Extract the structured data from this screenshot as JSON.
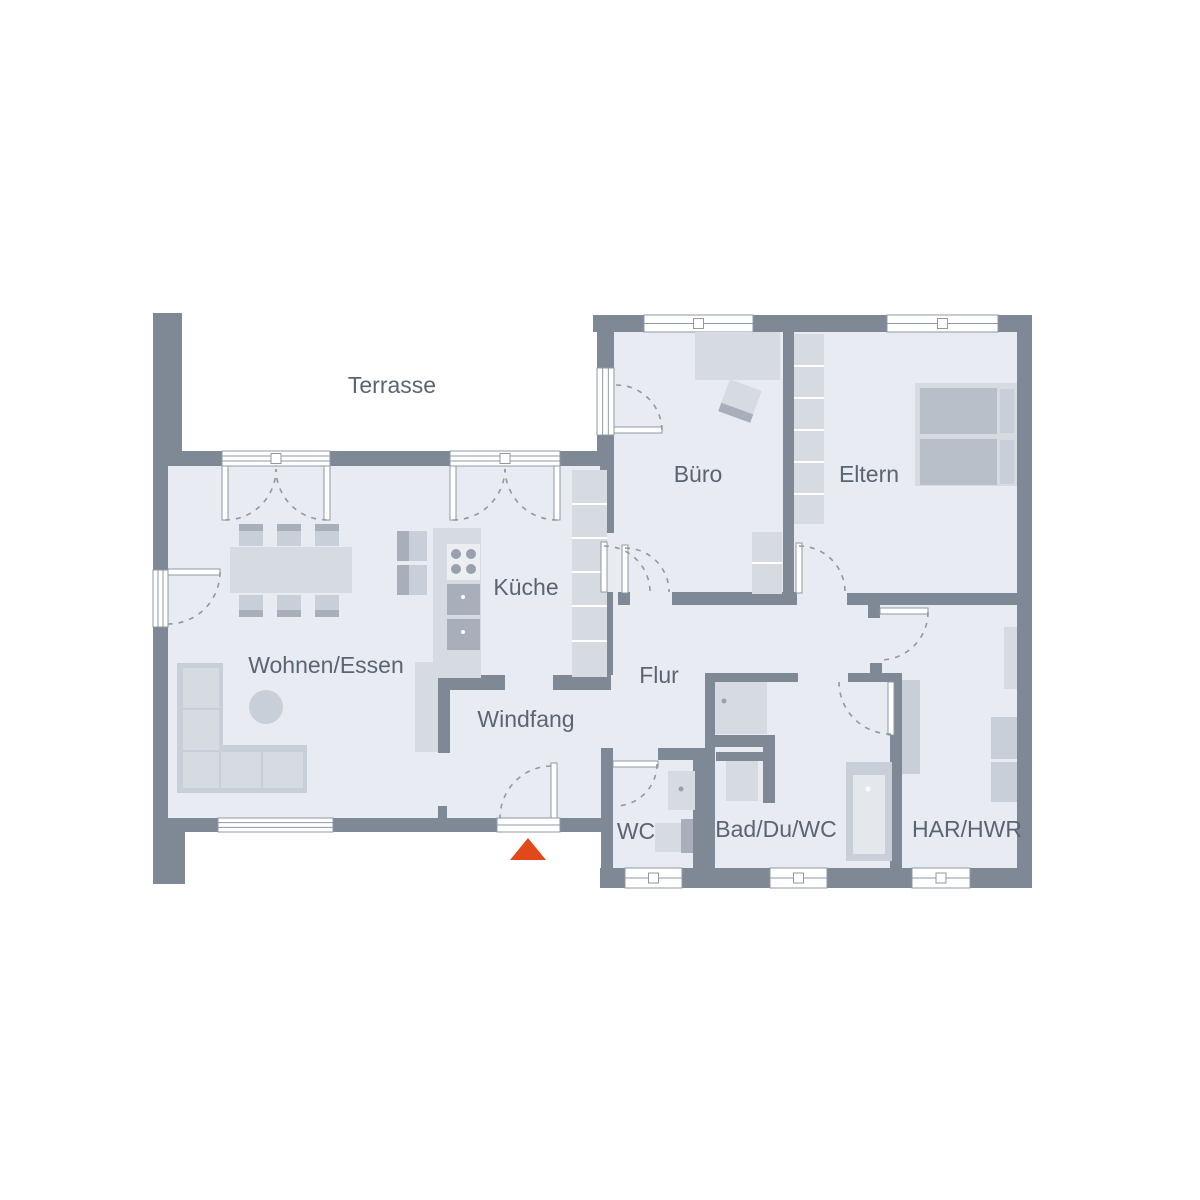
{
  "meta": {
    "title": "Grundriss Erdgeschoss"
  },
  "colors": {
    "background": "#ffffff",
    "wall": "#7f8995",
    "floor": "#e8ebf1",
    "furn1": "#d6dae1",
    "furn2": "#c9cfd8",
    "furn3": "#a8afbb",
    "matt": "#b9bfc9",
    "lite": "#e4e7ec",
    "panel": "#eceef2",
    "dark": "#98a1ad",
    "white": "#ffffff",
    "frame": "#8f98a4",
    "label": "#5b6472",
    "accent": "#e2491a"
  },
  "rooms": [
    {
      "id": "terrasse",
      "label": "Terrasse",
      "x": 392,
      "y": 387
    },
    {
      "id": "buero",
      "label": "Büro",
      "x": 698,
      "y": 476
    },
    {
      "id": "eltern",
      "label": "Eltern",
      "x": 869,
      "y": 476
    },
    {
      "id": "kueche",
      "label": "Küche",
      "x": 526,
      "y": 589
    },
    {
      "id": "wohnen-essen",
      "label": "Wohnen/Essen",
      "x": 326,
      "y": 667
    },
    {
      "id": "flur",
      "label": "Flur",
      "x": 659,
      "y": 677
    },
    {
      "id": "windfang",
      "label": "Windfang",
      "x": 526,
      "y": 721
    },
    {
      "id": "wc",
      "label": "WC",
      "x": 636,
      "y": 833
    },
    {
      "id": "bad-du-wc",
      "label": "Bad/Du/WC",
      "x": 776,
      "y": 831
    },
    {
      "id": "har-hwr",
      "label": "HAR/HWR",
      "x": 967,
      "y": 831
    }
  ],
  "plan": {
    "terrace_area": [
      182,
      313,
      415,
      138
    ],
    "floors": [
      [
        168,
        466,
        446,
        352
      ],
      [
        612,
        332,
        405,
        536
      ]
    ],
    "walls": [
      [
        153,
        313,
        29,
        149
      ],
      [
        153,
        451,
        15,
        381
      ],
      [
        153,
        832,
        32,
        52
      ],
      [
        168,
        451,
        54,
        15
      ],
      [
        330,
        451,
        120,
        15
      ],
      [
        560,
        451,
        54,
        15
      ],
      [
        168,
        818,
        50,
        14
      ],
      [
        333,
        818,
        164,
        14
      ],
      [
        560,
        818,
        53,
        14
      ],
      [
        438,
        806,
        9,
        12
      ],
      [
        597,
        315,
        17,
        53
      ],
      [
        597,
        435,
        17,
        16
      ],
      [
        593,
        315,
        51,
        17
      ],
      [
        753,
        315,
        134,
        17
      ],
      [
        998,
        315,
        34,
        17
      ],
      [
        1017,
        315,
        15,
        573
      ],
      [
        600,
        868,
        25,
        20
      ],
      [
        682,
        868,
        88,
        20
      ],
      [
        827,
        868,
        85,
        20
      ],
      [
        970,
        868,
        62,
        20
      ],
      [
        601,
        748,
        12,
        120
      ],
      [
        783,
        332,
        11,
        260
      ],
      [
        672,
        592,
        125,
        13
      ],
      [
        847,
        593,
        170,
        12
      ],
      [
        868,
        605,
        12,
        13
      ],
      [
        890,
        673,
        12,
        195
      ],
      [
        705,
        673,
        10,
        75
      ],
      [
        707,
        673,
        91,
        9
      ],
      [
        848,
        673,
        45,
        9
      ],
      [
        870,
        663,
        12,
        10
      ],
      [
        658,
        748,
        47,
        12
      ],
      [
        693,
        748,
        22,
        120
      ],
      [
        438,
        667,
        12,
        86
      ],
      [
        443,
        675,
        62,
        15
      ],
      [
        553,
        675,
        58,
        15
      ],
      [
        600,
        466,
        14,
        67
      ],
      [
        600,
        592,
        13,
        83
      ],
      [
        618,
        592,
        12,
        13
      ],
      [
        715,
        735,
        60,
        12
      ],
      [
        763,
        747,
        12,
        56
      ],
      [
        716,
        752,
        52,
        9
      ]
    ],
    "windows": [
      {
        "n": "french-door",
        "x": 222,
        "y": 451,
        "w": 108,
        "h": 15,
        "o": "h",
        "lines": 2,
        "sq": true
      },
      {
        "n": "french-door",
        "x": 450,
        "y": 451,
        "w": 110,
        "h": 15,
        "o": "h",
        "lines": 2,
        "sq": true
      },
      {
        "n": "window",
        "x": 644,
        "y": 315,
        "w": 109,
        "h": 17,
        "o": "h",
        "lines": 1,
        "sq": true
      },
      {
        "n": "window",
        "x": 887,
        "y": 315,
        "w": 111,
        "h": 17,
        "o": "h",
        "lines": 1,
        "sq": true
      },
      {
        "n": "window",
        "x": 218,
        "y": 818,
        "w": 115,
        "h": 14,
        "o": "h",
        "lines": 2,
        "sq": false
      },
      {
        "n": "entrance-sill",
        "x": 497,
        "y": 818,
        "w": 63,
        "h": 14,
        "o": "h",
        "lines": 1,
        "sq": false
      },
      {
        "n": "window",
        "x": 625,
        "y": 868,
        "w": 57,
        "h": 20,
        "o": "h",
        "lines": 1,
        "sq": true
      },
      {
        "n": "window",
        "x": 770,
        "y": 868,
        "w": 57,
        "h": 20,
        "o": "h",
        "lines": 1,
        "sq": true
      },
      {
        "n": "window",
        "x": 912,
        "y": 868,
        "w": 58,
        "h": 20,
        "o": "h",
        "lines": 1,
        "sq": true
      },
      {
        "n": "window-door",
        "x": 153,
        "y": 570,
        "w": 15,
        "h": 57,
        "o": "v",
        "lines": 2,
        "sq": false
      },
      {
        "n": "terrace-door",
        "x": 597,
        "y": 368,
        "w": 17,
        "h": 67,
        "o": "v",
        "lines": 2,
        "sq": false
      }
    ],
    "leaves": [
      [
        551,
        763,
        6,
        55
      ],
      [
        168,
        569,
        52,
        6
      ],
      [
        614,
        427,
        48,
        6
      ],
      [
        601,
        542,
        6,
        50
      ],
      [
        622,
        545,
        6,
        48
      ],
      [
        796,
        543,
        6,
        50
      ],
      [
        880,
        608,
        48,
        6
      ],
      [
        888,
        682,
        6,
        53
      ],
      [
        613,
        761,
        45,
        6
      ],
      [
        222,
        466,
        6,
        54
      ],
      [
        324,
        466,
        6,
        54
      ],
      [
        450,
        466,
        6,
        54
      ],
      [
        554,
        466,
        6,
        54
      ]
    ],
    "arcs": [
      "M551,766 A52,52 0 0 0 500,818",
      "M220,572 A52,52 0 0 1 168,624",
      "M662,430 A46,46 0 0 0 616,385",
      "M225,520 A51,51 0 0 0 276,469",
      "M327,520 A51,51 0 0 1 276,469",
      "M453,520 A52,52 0 0 0 505,469",
      "M557,520 A52,52 0 0 1 505,469",
      "M604,546 A46,46 0 0 1 650,592",
      "M625,548 A44,44 0 0 1 669,592",
      "M799,546 A46,46 0 0 1 845,592",
      "M928,612 A48,48 0 0 1 880,660",
      "M891,734 A52,52 0 0 1 839,682",
      "M657,764 A42,42 0 0 1 615,806"
    ],
    "furniture": [
      {
        "t": "r",
        "n": "dining-table",
        "x": 230,
        "y": 547,
        "w": 122,
        "h": 46,
        "f": "furn1"
      },
      {
        "t": "r",
        "n": "dining-chair",
        "x": 239,
        "y": 524,
        "w": 24,
        "h": 22,
        "f": "furn2"
      },
      {
        "t": "r",
        "n": "dining-chair",
        "x": 277,
        "y": 524,
        "w": 24,
        "h": 22,
        "f": "furn2"
      },
      {
        "t": "r",
        "n": "dining-chair",
        "x": 315,
        "y": 524,
        "w": 24,
        "h": 22,
        "f": "furn2"
      },
      {
        "t": "r",
        "n": "chair-back",
        "x": 239,
        "y": 524,
        "w": 24,
        "h": 7,
        "f": "furn3"
      },
      {
        "t": "r",
        "n": "chair-back",
        "x": 277,
        "y": 524,
        "w": 24,
        "h": 7,
        "f": "furn3"
      },
      {
        "t": "r",
        "n": "chair-back",
        "x": 315,
        "y": 524,
        "w": 24,
        "h": 7,
        "f": "furn3"
      },
      {
        "t": "r",
        "n": "dining-chair",
        "x": 239,
        "y": 595,
        "w": 24,
        "h": 22,
        "f": "furn2"
      },
      {
        "t": "r",
        "n": "dining-chair",
        "x": 277,
        "y": 595,
        "w": 24,
        "h": 22,
        "f": "furn2"
      },
      {
        "t": "r",
        "n": "dining-chair",
        "x": 315,
        "y": 595,
        "w": 24,
        "h": 22,
        "f": "furn2"
      },
      {
        "t": "r",
        "n": "chair-back",
        "x": 239,
        "y": 610,
        "w": 24,
        "h": 7,
        "f": "furn3"
      },
      {
        "t": "r",
        "n": "chair-back",
        "x": 277,
        "y": 610,
        "w": 24,
        "h": 7,
        "f": "furn3"
      },
      {
        "t": "r",
        "n": "chair-back",
        "x": 315,
        "y": 610,
        "w": 24,
        "h": 7,
        "f": "furn3"
      },
      {
        "t": "r",
        "n": "sofa",
        "x": 177,
        "y": 663,
        "w": 46,
        "h": 130,
        "f": "furn2"
      },
      {
        "t": "r",
        "n": "sofa",
        "x": 223,
        "y": 745,
        "w": 84,
        "h": 48,
        "f": "furn2"
      },
      {
        "t": "r",
        "n": "sofa-cushion",
        "x": 183,
        "y": 668,
        "w": 36,
        "h": 40,
        "f": "furn1"
      },
      {
        "t": "r",
        "n": "sofa-cushion",
        "x": 183,
        "y": 710,
        "w": 36,
        "h": 40,
        "f": "furn1"
      },
      {
        "t": "r",
        "n": "sofa-cushion",
        "x": 183,
        "y": 752,
        "w": 36,
        "h": 36,
        "f": "furn1"
      },
      {
        "t": "r",
        "n": "sofa-cushion",
        "x": 221,
        "y": 752,
        "w": 40,
        "h": 36,
        "f": "furn1"
      },
      {
        "t": "r",
        "n": "sofa-cushion",
        "x": 263,
        "y": 752,
        "w": 40,
        "h": 36,
        "f": "furn1"
      },
      {
        "t": "c",
        "n": "coffee-table",
        "cx": 266,
        "cy": 707,
        "r": 17,
        "f": "furn2"
      },
      {
        "t": "r",
        "n": "kitchen-counter",
        "x": 433,
        "y": 528,
        "w": 48,
        "h": 150,
        "f": "furn1"
      },
      {
        "t": "r",
        "n": "cooktop",
        "x": 447,
        "y": 544,
        "w": 33,
        "h": 36,
        "f": "panel"
      },
      {
        "t": "c",
        "n": "burner",
        "cx": 456,
        "cy": 554,
        "r": 5,
        "f": "dark"
      },
      {
        "t": "c",
        "n": "burner",
        "cx": 471,
        "cy": 554,
        "r": 5,
        "f": "dark"
      },
      {
        "t": "c",
        "n": "burner",
        "cx": 456,
        "cy": 569,
        "r": 5,
        "f": "dark"
      },
      {
        "t": "c",
        "n": "burner",
        "cx": 471,
        "cy": 569,
        "r": 5,
        "f": "dark"
      },
      {
        "t": "r",
        "n": "oven",
        "x": 447,
        "y": 584,
        "w": 33,
        "h": 31,
        "f": "furn3"
      },
      {
        "t": "r",
        "n": "oven-drawer",
        "x": 447,
        "y": 619,
        "w": 33,
        "h": 31,
        "f": "furn3"
      },
      {
        "t": "c",
        "n": "oven-knob",
        "cx": 463,
        "cy": 597,
        "r": 2,
        "f": "white"
      },
      {
        "t": "c",
        "n": "oven-knob",
        "cx": 463,
        "cy": 632,
        "r": 2,
        "f": "white"
      },
      {
        "t": "r",
        "n": "stool",
        "x": 397,
        "y": 531,
        "w": 30,
        "h": 30,
        "f": "furn2"
      },
      {
        "t": "r",
        "n": "stool",
        "x": 397,
        "y": 565,
        "w": 30,
        "h": 30,
        "f": "furn2"
      },
      {
        "t": "r",
        "n": "stool-edge",
        "x": 397,
        "y": 531,
        "w": 12,
        "h": 30,
        "f": "furn3"
      },
      {
        "t": "r",
        "n": "stool-edge",
        "x": 397,
        "y": 565,
        "w": 12,
        "h": 30,
        "f": "furn3"
      },
      {
        "t": "r",
        "n": "kitchen-cabinets",
        "x": 572,
        "y": 470,
        "w": 35,
        "h": 207,
        "f": "furn1"
      },
      {
        "t": "r",
        "n": "cabinet-divider",
        "x": 572,
        "y": 503,
        "w": 35,
        "h": 2,
        "f": "white"
      },
      {
        "t": "r",
        "n": "cabinet-divider",
        "x": 572,
        "y": 537,
        "w": 35,
        "h": 2,
        "f": "white"
      },
      {
        "t": "r",
        "n": "cabinet-divider",
        "x": 572,
        "y": 571,
        "w": 35,
        "h": 2,
        "f": "white"
      },
      {
        "t": "r",
        "n": "cabinet-divider",
        "x": 572,
        "y": 605,
        "w": 35,
        "h": 2,
        "f": "white"
      },
      {
        "t": "r",
        "n": "cabinet-divider",
        "x": 572,
        "y": 640,
        "w": 35,
        "h": 2,
        "f": "white"
      },
      {
        "t": "r",
        "n": "desk",
        "x": 695,
        "y": 332,
        "w": 85,
        "h": 48,
        "f": "furn1"
      },
      {
        "t": "r",
        "n": "office-chair",
        "x": 723,
        "y": 384,
        "w": 34,
        "h": 34,
        "f": "furn1",
        "rot": 20,
        "rx": 740,
        "ry": 401
      },
      {
        "t": "r",
        "n": "office-chair-back",
        "x": 723,
        "y": 409,
        "w": 34,
        "h": 9,
        "f": "furn3",
        "rot": 20,
        "rx": 740,
        "ry": 401
      },
      {
        "t": "r",
        "n": "cabinet",
        "x": 752,
        "y": 532,
        "w": 30,
        "h": 62,
        "f": "furn1"
      },
      {
        "t": "r",
        "n": "cabinet-divider",
        "x": 752,
        "y": 562,
        "w": 30,
        "h": 2,
        "f": "white"
      },
      {
        "t": "r",
        "n": "wardrobe",
        "x": 794,
        "y": 334,
        "w": 30,
        "h": 190,
        "f": "furn1"
      },
      {
        "t": "r",
        "n": "wardrobe-divider",
        "x": 794,
        "y": 365,
        "w": 30,
        "h": 2,
        "f": "white"
      },
      {
        "t": "r",
        "n": "wardrobe-divider",
        "x": 794,
        "y": 397,
        "w": 30,
        "h": 2,
        "f": "white"
      },
      {
        "t": "r",
        "n": "wardrobe-divider",
        "x": 794,
        "y": 429,
        "w": 30,
        "h": 2,
        "f": "white"
      },
      {
        "t": "r",
        "n": "wardrobe-divider",
        "x": 794,
        "y": 461,
        "w": 30,
        "h": 2,
        "f": "white"
      },
      {
        "t": "r",
        "n": "wardrobe-divider",
        "x": 794,
        "y": 493,
        "w": 30,
        "h": 2,
        "f": "white"
      },
      {
        "t": "r",
        "n": "bed-frame",
        "x": 915,
        "y": 383,
        "w": 102,
        "h": 103,
        "f": "furn1"
      },
      {
        "t": "r",
        "n": "mattress",
        "x": 920,
        "y": 388,
        "w": 77,
        "h": 46,
        "f": "matt"
      },
      {
        "t": "r",
        "n": "mattress",
        "x": 920,
        "y": 439,
        "w": 77,
        "h": 46,
        "f": "matt"
      },
      {
        "t": "r",
        "n": "pillow",
        "x": 1000,
        "y": 389,
        "w": 14,
        "h": 44,
        "f": "furn2"
      },
      {
        "t": "r",
        "n": "pillow",
        "x": 1000,
        "y": 440,
        "w": 14,
        "h": 44,
        "f": "furn2"
      },
      {
        "t": "r",
        "n": "sideboard",
        "x": 415,
        "y": 662,
        "w": 23,
        "h": 90,
        "f": "furn1"
      },
      {
        "t": "r",
        "n": "washbasin",
        "x": 668,
        "y": 771,
        "w": 27,
        "h": 39,
        "f": "furn1"
      },
      {
        "t": "c",
        "n": "faucet-dot",
        "cx": 681,
        "cy": 789,
        "r": 2.5,
        "f": "dark"
      },
      {
        "t": "r",
        "n": "toilet-tank",
        "x": 681,
        "y": 819,
        "w": 12,
        "h": 34,
        "f": "furn3"
      },
      {
        "t": "r",
        "n": "toilet",
        "x": 655,
        "y": 823,
        "w": 26,
        "h": 29,
        "f": "furn1"
      },
      {
        "t": "r",
        "n": "shower",
        "x": 715,
        "y": 682,
        "w": 52,
        "h": 52,
        "f": "furn1"
      },
      {
        "t": "c",
        "n": "shower-drain",
        "cx": 724,
        "cy": 701,
        "r": 2.5,
        "f": "dark"
      },
      {
        "t": "r",
        "n": "washbasin",
        "x": 726,
        "y": 761,
        "w": 32,
        "h": 40,
        "f": "furn1"
      },
      {
        "t": "r",
        "n": "bathtub",
        "x": 846,
        "y": 762,
        "w": 46,
        "h": 99,
        "f": "furn2"
      },
      {
        "t": "r",
        "n": "bathtub-inner",
        "x": 853,
        "y": 775,
        "w": 32,
        "h": 79,
        "f": "lite"
      },
      {
        "t": "c",
        "n": "faucet-dot",
        "cx": 868,
        "cy": 789,
        "r": 2.5,
        "f": "white"
      },
      {
        "t": "r",
        "n": "shaft",
        "x": 902,
        "y": 680,
        "w": 18,
        "h": 94,
        "f": "furn2"
      },
      {
        "t": "r",
        "n": "tall-cabinet",
        "x": 1004,
        "y": 627,
        "w": 13,
        "h": 62,
        "f": "furn1"
      },
      {
        "t": "r",
        "n": "washer",
        "x": 991,
        "y": 717,
        "w": 26,
        "h": 42,
        "f": "furn2"
      },
      {
        "t": "r",
        "n": "dryer",
        "x": 991,
        "y": 762,
        "w": 26,
        "h": 40,
        "f": "furn2"
      }
    ],
    "entrance_marker": {
      "points": "528,838 546,860 510,860"
    },
    "label_font_size": 23
  }
}
